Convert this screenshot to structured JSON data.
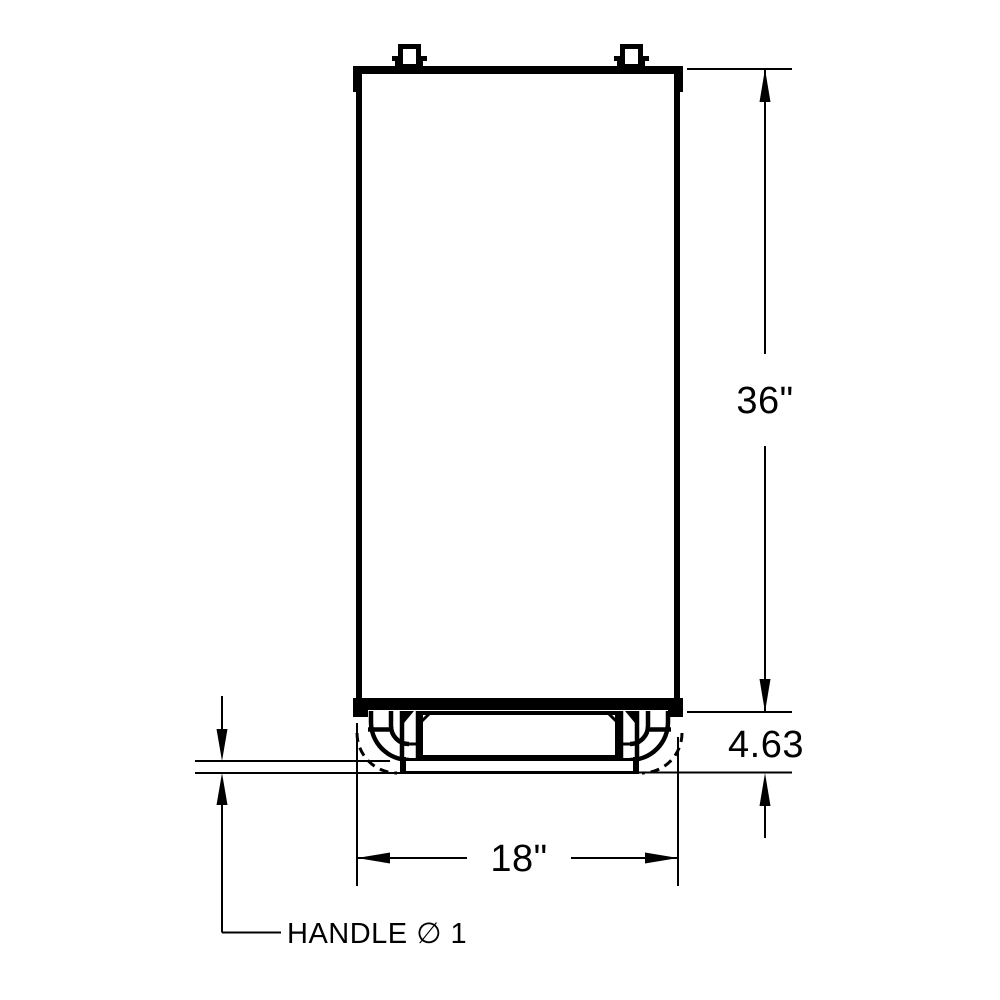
{
  "colors": {
    "background": "#ffffff",
    "line": "#000000"
  },
  "drawing": {
    "type": "dimensioned-front-view",
    "dimensions": {
      "height": "36\"",
      "base_height": "4.63",
      "width": "18\"",
      "handle": "HANDLE ∅ 1"
    }
  }
}
